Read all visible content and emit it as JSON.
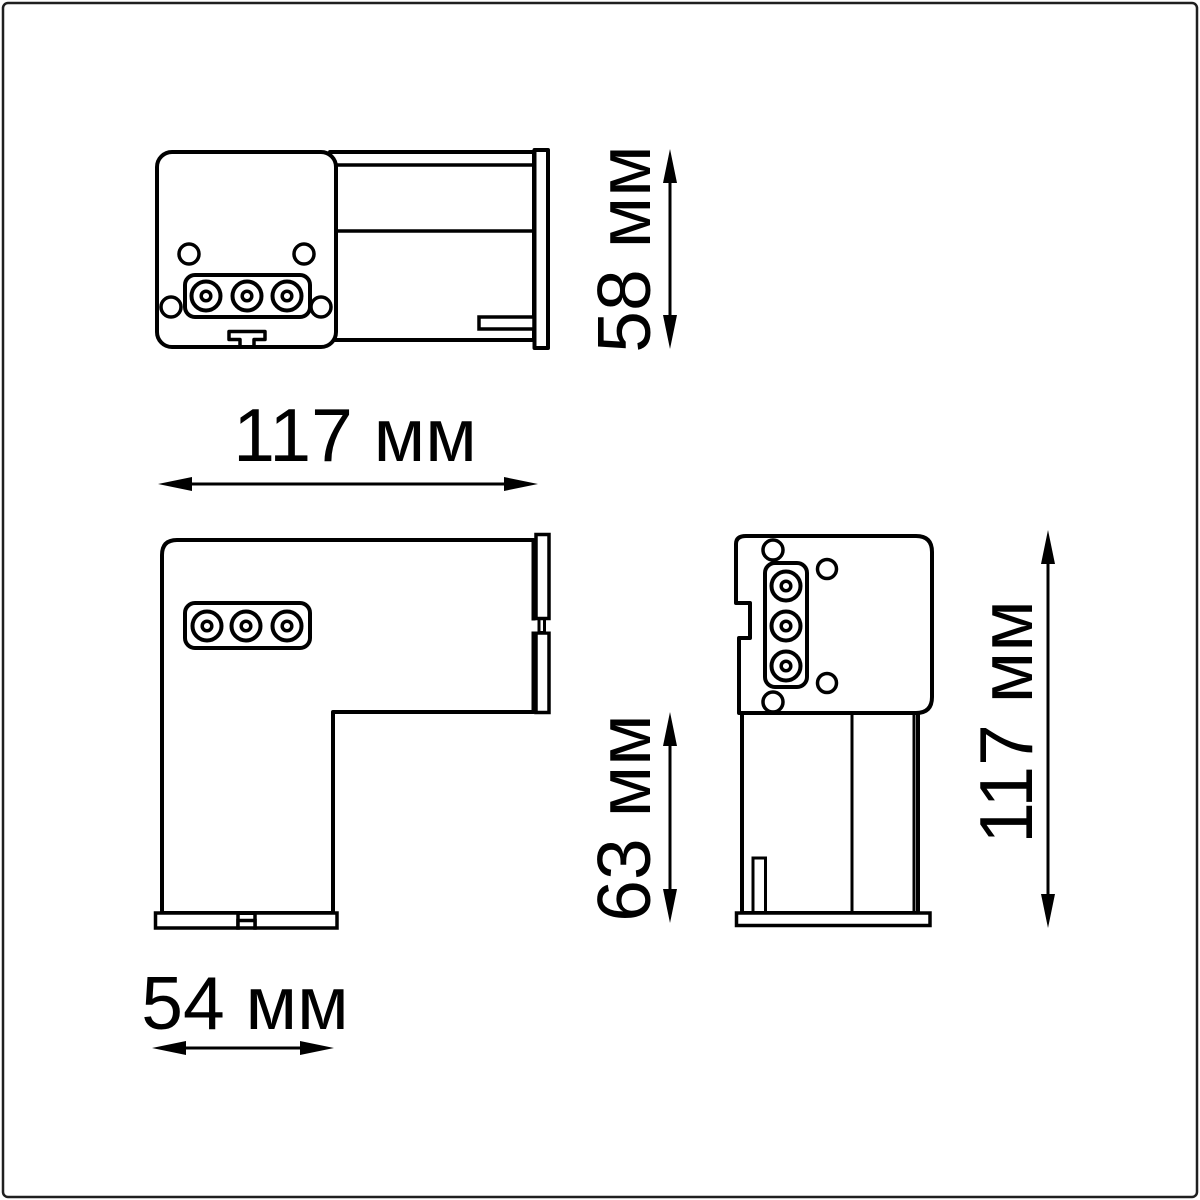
{
  "drawing": {
    "type": "dimensioned-technical-drawing",
    "views": [
      "top-view",
      "side-view",
      "front-view"
    ],
    "colors": {
      "line": "#000000",
      "background": "#ffffff",
      "frame": "#1f1f1f"
    },
    "dimensions": {
      "top_view_height": "58 мм",
      "top_view_width": "117 мм",
      "side_view_foot_height": "63 мм",
      "side_view_foot_width": "54 мм",
      "front_view_height": "117 мм"
    }
  }
}
